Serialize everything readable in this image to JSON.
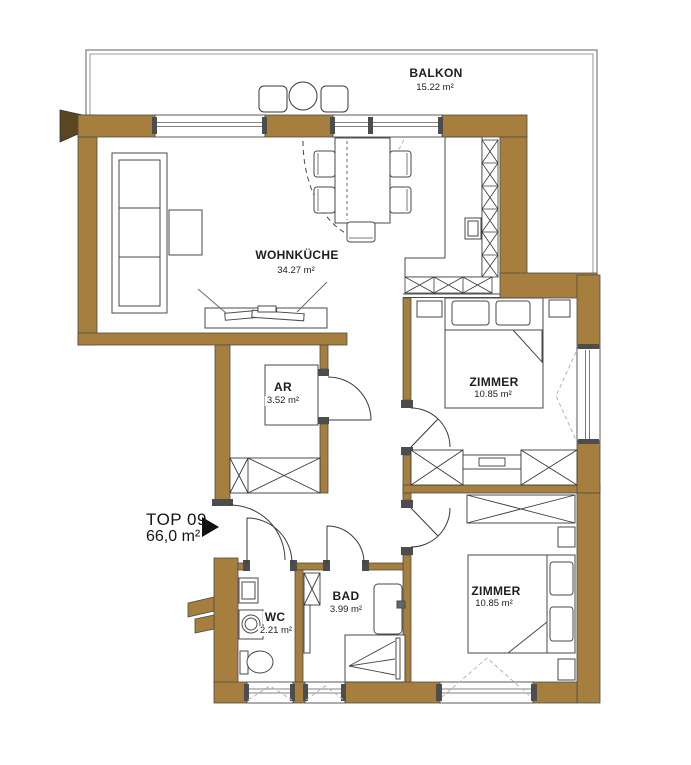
{
  "plan": {
    "unit": {
      "label": "TOP 09",
      "area": "66,0 m²"
    },
    "rooms": {
      "balkon": {
        "name": "BALKON",
        "area": "15.22 m²"
      },
      "wohnkueche": {
        "name": "WOHNKÜCHE",
        "area": "34.27 m²"
      },
      "ar": {
        "name": "AR",
        "area": "3.52 m²"
      },
      "zimmer1": {
        "name": "ZIMMER",
        "area": "10.85 m²"
      },
      "zimmer2": {
        "name": "ZIMMER",
        "area": "10.85 m²"
      },
      "wc": {
        "name": "WC",
        "area": "2.21 m²"
      },
      "bad": {
        "name": "BAD",
        "area": "3.99 m²"
      }
    },
    "colors": {
      "wall": "#A67E3E",
      "outline": "#4B4B4B",
      "balcony_line": "#7D7D7D",
      "tilt_dash": "#B5B5B5"
    }
  }
}
